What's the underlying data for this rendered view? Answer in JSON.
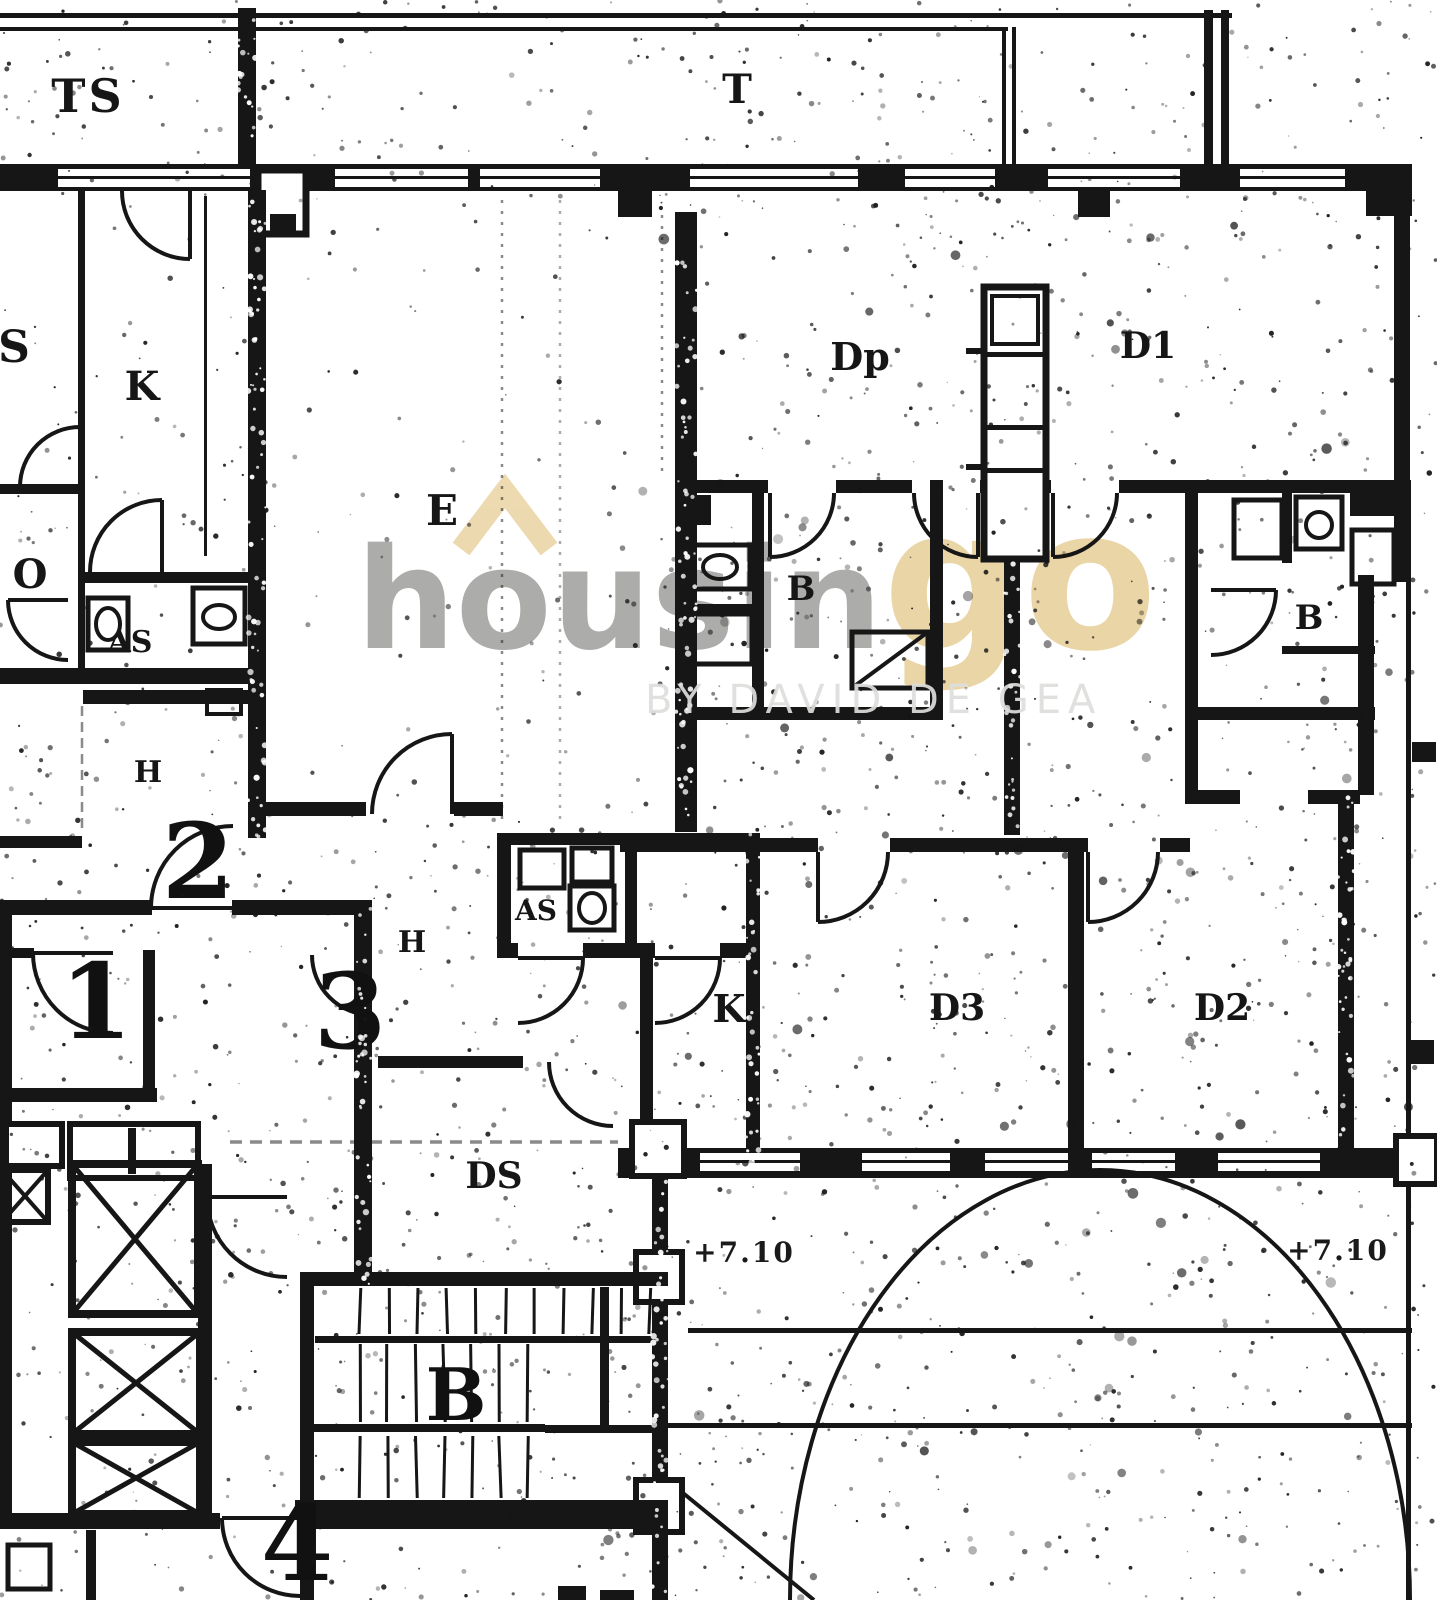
{
  "watermark": {
    "brand_left": "housin",
    "brand_right": "go",
    "tagline": "BY DAVID DE GEA",
    "color_gray": "#a6a6a4",
    "color_tan": "#e9d2a0",
    "chevron_color": "#ecd7ab"
  },
  "plan": {
    "type": "scanned-floor-plan",
    "ink_color": "#161616",
    "paper_color": "#ffffff",
    "labels": {
      "terrace_ts": "TS",
      "terrace_t": "T",
      "room_s": "S",
      "kitchen_left": "K",
      "living_e": "E",
      "room_o": "O",
      "aseo_left": "AS",
      "hall_left": "H",
      "door_2": "2",
      "door_1": "1",
      "door_3": "3",
      "door_4": "4",
      "hall_center": "H",
      "aseo_center": "AS",
      "kitchen_center": "K",
      "bedroom_dp": "Dp",
      "bedroom_d1": "D1",
      "bath_center": "B",
      "bath_right": "B",
      "bedroom_d3": "D3",
      "bedroom_d2": "D2",
      "room_ds": "DS",
      "stair_mark": "B",
      "level_left": "+7.10",
      "level_right": "+7.10"
    }
  }
}
